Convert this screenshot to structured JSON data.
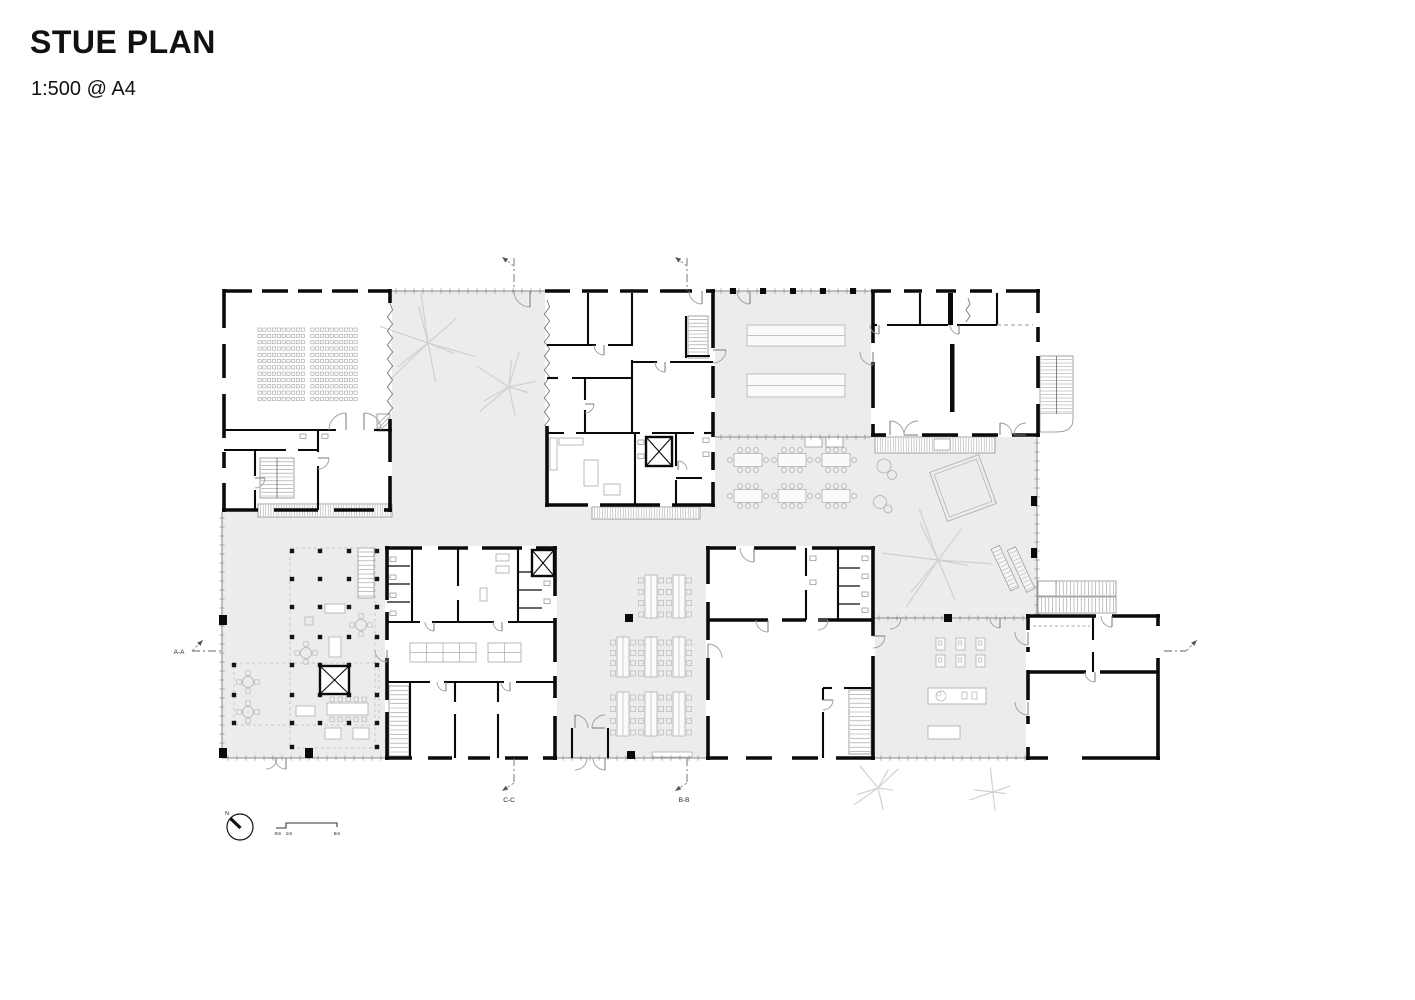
{
  "header": {
    "title": "STUE PLAN",
    "scale": "1:500 @ A4"
  },
  "plan": {
    "section_markers": {
      "a": "A-A",
      "b": "B-B",
      "c": "C-C"
    },
    "north_label": "N",
    "scale_bar": {
      "zero": "0m",
      "one": "1m",
      "five": "5m"
    }
  },
  "palette": {
    "wall": "#0a0a0a",
    "open_space_fill": "#ececec",
    "glazing": "#8a8a8a",
    "furniture": "#b0b0b0",
    "tree": "#cdcdcd"
  }
}
